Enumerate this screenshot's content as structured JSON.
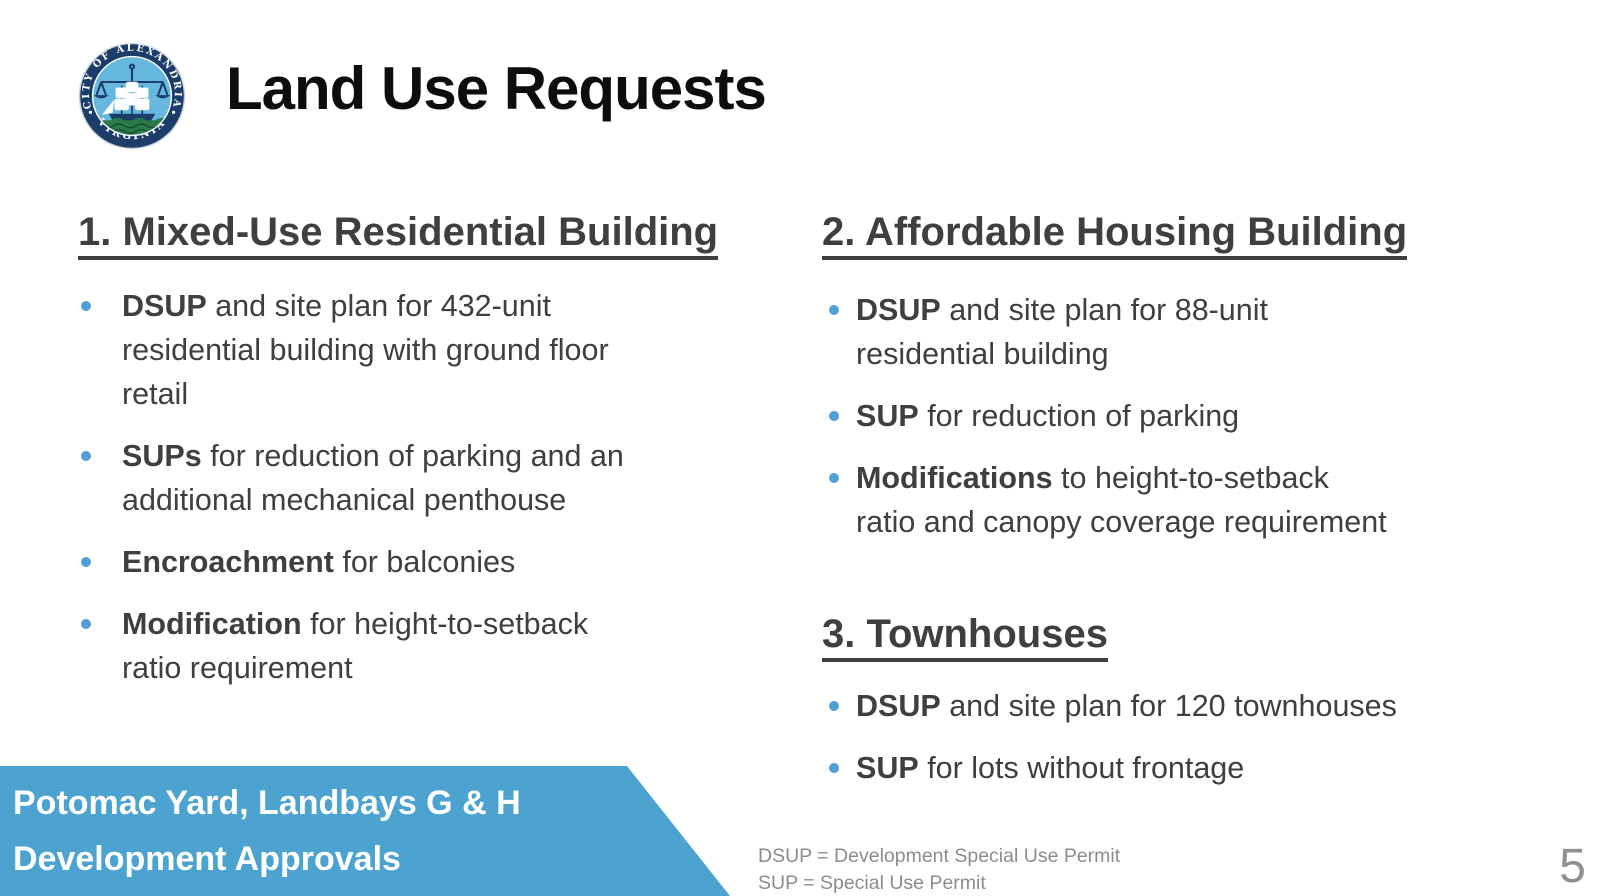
{
  "slide": {
    "title": "Land Use Requests",
    "page_number": "5"
  },
  "logo": {
    "name": "City of Alexandria Virginia seal",
    "ring_text_top": "CITY OF ALEXANDRIA",
    "ring_text_bottom": "VIRGINIA"
  },
  "sections": [
    {
      "heading": "1. Mixed-Use Residential Building",
      "bullets": [
        {
          "lines": [
            {
              "b": "DSUP",
              "t": " and site plan for 432-unit"
            },
            {
              "b": "",
              "t": "residential building with ground floor"
            },
            {
              "b": "",
              "t": "retail"
            }
          ]
        },
        {
          "lines": [
            {
              "b": "SUPs",
              "t": " for reduction of parking and an"
            },
            {
              "b": "",
              "t": "additional mechanical penthouse"
            }
          ]
        },
        {
          "lines": [
            {
              "b": "Encroachment",
              "t": " for balconies"
            }
          ]
        },
        {
          "lines": [
            {
              "b": "Modification",
              "t": " for height-to-setback"
            },
            {
              "b": "",
              "t": "ratio requirement"
            }
          ]
        }
      ]
    },
    {
      "heading": "2. Affordable Housing Building",
      "bullets": [
        {
          "lines": [
            {
              "b": "DSUP",
              "t": " and site plan for 88-unit"
            },
            {
              "b": "",
              "t": "residential building"
            }
          ]
        },
        {
          "lines": [
            {
              "b": "SUP",
              "t": " for reduction of parking"
            }
          ]
        },
        {
          "lines": [
            {
              "b": "Modifications",
              "t": " to height-to-setback"
            },
            {
              "b": "",
              "t": "ratio and canopy coverage requirement"
            }
          ]
        }
      ]
    },
    {
      "heading": "3. Townhouses",
      "bullets": [
        {
          "lines": [
            {
              "b": "DSUP",
              "t": " and site plan for 120 townhouses"
            }
          ]
        },
        {
          "lines": [
            {
              "b": "SUP",
              "t": " for lots without frontage"
            }
          ]
        }
      ]
    }
  ],
  "banner": {
    "line1": "Potomac Yard, Landbays G & H",
    "line2": "Development Approvals"
  },
  "footnote": {
    "line1": "DSUP = Development Special Use Permit",
    "line2": "SUP = Special Use Permit"
  },
  "colors": {
    "banner_blue": "#4DA3CF",
    "bullet_blue": "#4F9FD4",
    "text_gray": "#3F3F3F",
    "title_black": "#0D0D0D",
    "footnote_gray": "#8C8C8C",
    "seal_navy": "#1C3C69",
    "seal_light_blue": "#66B8DE",
    "seal_green": "#2A7A4C"
  }
}
